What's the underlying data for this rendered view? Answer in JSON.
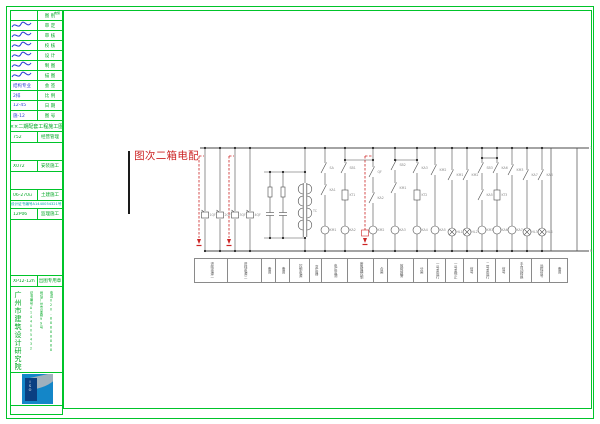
{
  "colors": {
    "frame_green": "#00c42a",
    "text_green": "#00a824",
    "hand_blue": "#2b3fd4",
    "cyan": "#00a7a7",
    "red": "#cc2424",
    "line": "#4a4a4a",
    "label_gray": "#8a8a8a",
    "stamp_blue": "#1486c8",
    "stamp_navy": "#0a3f82"
  },
  "drawing_title": {
    "text": "配电箱二次图"
  },
  "stamp": {
    "cert_text": "ISO"
  },
  "titleblock": {
    "rows": [
      {
        "h": 10,
        "type": "kv",
        "v": "",
        "l": "图 别",
        "tiny": "电施"
      },
      {
        "h": 10,
        "type": "sig",
        "l": "审 定"
      },
      {
        "h": 10,
        "type": "sig",
        "l": "审 核"
      },
      {
        "h": 10,
        "type": "sig",
        "l": "校 核"
      },
      {
        "h": 10,
        "type": "sig",
        "l": "设 计"
      },
      {
        "h": 10,
        "type": "sig",
        "l": "制 图"
      },
      {
        "h": 10,
        "type": "sig",
        "l": "描 图"
      },
      {
        "h": 10,
        "type": "kv",
        "v": "结构专业",
        "l": "会 签",
        "vc": "blue"
      },
      {
        "h": 10,
        "type": "kv",
        "v": "2排",
        "l": "比 例",
        "vc": "blue"
      },
      {
        "h": 10,
        "type": "kv",
        "v": "12-45",
        "l": "日 期",
        "vc": "blue"
      },
      {
        "h": 10,
        "type": "kv",
        "v": "施-12",
        "l": "图 号",
        "vc": "blue"
      },
      {
        "h": 11,
        "type": "banner",
        "t": "××二期配套工程施工图"
      },
      {
        "h": 11,
        "type": "kv",
        "v": "752",
        "l": "经营管理"
      },
      {
        "h": 18,
        "type": "empty"
      },
      {
        "h": 11,
        "type": "kv",
        "v": "X072",
        "l": "安装施工"
      },
      {
        "h": 18,
        "type": "empty"
      },
      {
        "h": 11,
        "type": "kv",
        "v": "06-270u",
        "l": "土建施工"
      },
      {
        "h": 8,
        "type": "cyan",
        "t": "设计证书编号A1440054321号"
      },
      {
        "h": 11,
        "type": "kv",
        "v": "12P06",
        "l": "监理施工"
      },
      {
        "h": 56,
        "type": "empty"
      },
      {
        "h": 11,
        "type": "kv",
        "v": "XP12-12h",
        "l": "出图专用章"
      },
      {
        "h": 86,
        "type": "institute"
      },
      {
        "h": 33,
        "type": "stamp"
      }
    ],
    "institute": {
      "name": "广州市建筑设计研究院",
      "cols": [
        "证书编号A144005432",
        "地址广州市某路99号",
        "电话020-88888888"
      ]
    }
  },
  "diagram": {
    "top_bus": {
      "y": 148,
      "x1": 200,
      "x2": 577
    },
    "bottom_bus": {
      "y": 251,
      "x1": 205,
      "x2": 577
    },
    "right_rect": {
      "x1": 551,
      "x2": 577,
      "stub_x": 589,
      "top_label": "1",
      "bottom_label": "N"
    },
    "feeders": [
      {
        "x": 205,
        "dash": true,
        "label": "1QF"
      },
      {
        "x": 220,
        "label": "2QF"
      },
      {
        "x": 235,
        "dash": true,
        "label": "3QF"
      },
      {
        "x": 250,
        "label": "4QF"
      }
    ],
    "cap_loop": {
      "x1": 264,
      "x2": 305,
      "y1": 172,
      "y2": 238,
      "branches": [
        {
          "x": 270,
          "label": "FU1"
        },
        {
          "x": 283,
          "label": "FU2"
        }
      ]
    },
    "transformer": {
      "x": 305,
      "label": "TC"
    },
    "branches": [
      {
        "x": 325,
        "elems": [
          {
            "t": "contact",
            "y": 168,
            "lbl": "SA"
          },
          {
            "t": "contact",
            "y": 190,
            "lbl": "KA1"
          },
          {
            "t": "coil",
            "y": 230,
            "lbl": "KM1"
          }
        ]
      },
      {
        "x": 345,
        "elems": [
          {
            "t": "contact",
            "y": 168,
            "lbl": "SB1"
          },
          {
            "t": "box",
            "y": 195,
            "lbl": "KT1"
          },
          {
            "t": "coil",
            "y": 230,
            "lbl": "KA2"
          }
        ]
      },
      {
        "x": 373,
        "dash": true,
        "elems": [
          {
            "t": "contact",
            "y": 172,
            "lbl": "QF"
          },
          {
            "t": "contact",
            "y": 198,
            "lbl": "KA2"
          },
          {
            "t": "coil",
            "y": 230,
            "lbl": "KM2"
          }
        ]
      },
      {
        "x": 395,
        "elems": [
          {
            "t": "contact",
            "y": 165,
            "lbl": "SB2"
          },
          {
            "t": "contact",
            "y": 188,
            "lbl": "KM1"
          },
          {
            "t": "coil",
            "y": 230,
            "lbl": "KA3"
          }
        ]
      },
      {
        "x": 417,
        "elems": [
          {
            "t": "contact",
            "y": 168,
            "lbl": "KA3"
          },
          {
            "t": "box",
            "y": 195,
            "lbl": "KT2"
          },
          {
            "t": "coil",
            "y": 230,
            "lbl": "KA4"
          }
        ]
      },
      {
        "x": 435,
        "elems": [
          {
            "t": "contact",
            "y": 170,
            "lbl": "KM2"
          },
          {
            "t": "coil",
            "y": 230,
            "lbl": "KA5"
          }
        ]
      },
      {
        "x": 452,
        "elems": [
          {
            "t": "contact",
            "y": 175,
            "lbl": "KM1"
          },
          {
            "t": "lamp",
            "y": 232,
            "lbl": "HL1"
          }
        ]
      },
      {
        "x": 467,
        "elems": [
          {
            "t": "contact",
            "y": 175,
            "lbl": "KM2"
          },
          {
            "t": "lamp",
            "y": 232,
            "lbl": "HL2"
          }
        ]
      },
      {
        "x": 482,
        "elems": [
          {
            "t": "contact",
            "y": 168,
            "lbl": "SB3"
          },
          {
            "t": "contact",
            "y": 195,
            "lbl": "KA5"
          },
          {
            "t": "coil",
            "y": 230,
            "lbl": "KM3"
          }
        ]
      },
      {
        "x": 497,
        "elems": [
          {
            "t": "contact",
            "y": 168,
            "lbl": "KA6"
          },
          {
            "t": "box",
            "y": 195,
            "lbl": "KT3"
          },
          {
            "t": "coil",
            "y": 230,
            "lbl": "KA6"
          }
        ]
      },
      {
        "x": 512,
        "elems": [
          {
            "t": "contact",
            "y": 170,
            "lbl": "KM3"
          },
          {
            "t": "coil",
            "y": 230,
            "lbl": "KA7"
          }
        ]
      },
      {
        "x": 527,
        "elems": [
          {
            "t": "contact",
            "y": 175,
            "lbl": "KA7"
          },
          {
            "t": "lamp",
            "y": 232,
            "lbl": "HL3"
          }
        ]
      },
      {
        "x": 542,
        "elems": [
          {
            "t": "contact",
            "y": 175,
            "lbl": "KA8"
          },
          {
            "t": "lamp",
            "y": 232,
            "lbl": "HL4"
          }
        ]
      }
    ],
    "jumpers": [
      {
        "x1": 345,
        "x2": 373,
        "y": 160
      },
      {
        "x1": 395,
        "x2": 417,
        "y": 160
      },
      {
        "x1": 482,
        "x2": 497,
        "y": 158
      }
    ]
  },
  "func_table": {
    "cells": [
      {
        "w": 34,
        "label": "进线电源一"
      },
      {
        "w": 34,
        "label": "进线电源二"
      },
      {
        "w": 14,
        "label": "备用"
      },
      {
        "w": 14,
        "label": "备用"
      },
      {
        "w": 20,
        "label": "控制电源"
      },
      {
        "w": 12,
        "label": "变压器"
      },
      {
        "w": 26,
        "label": "电压监测"
      },
      {
        "w": 26,
        "label": "断路器控制"
      },
      {
        "w": 14,
        "label": "合闸"
      },
      {
        "w": 26,
        "label": "故障报警"
      },
      {
        "w": 14,
        "label": "分闸"
      },
      {
        "w": 18,
        "label": "一号泵运行"
      },
      {
        "w": 18,
        "label": "一号泵停止"
      },
      {
        "w": 14,
        "label": "信号"
      },
      {
        "w": 18,
        "label": "二号泵运行"
      },
      {
        "w": 14,
        "label": "信号"
      },
      {
        "w": 22,
        "label": "手自动转换"
      },
      {
        "w": 18,
        "label": "远程信号"
      },
      {
        "w": 18,
        "label": "备用"
      }
    ]
  }
}
